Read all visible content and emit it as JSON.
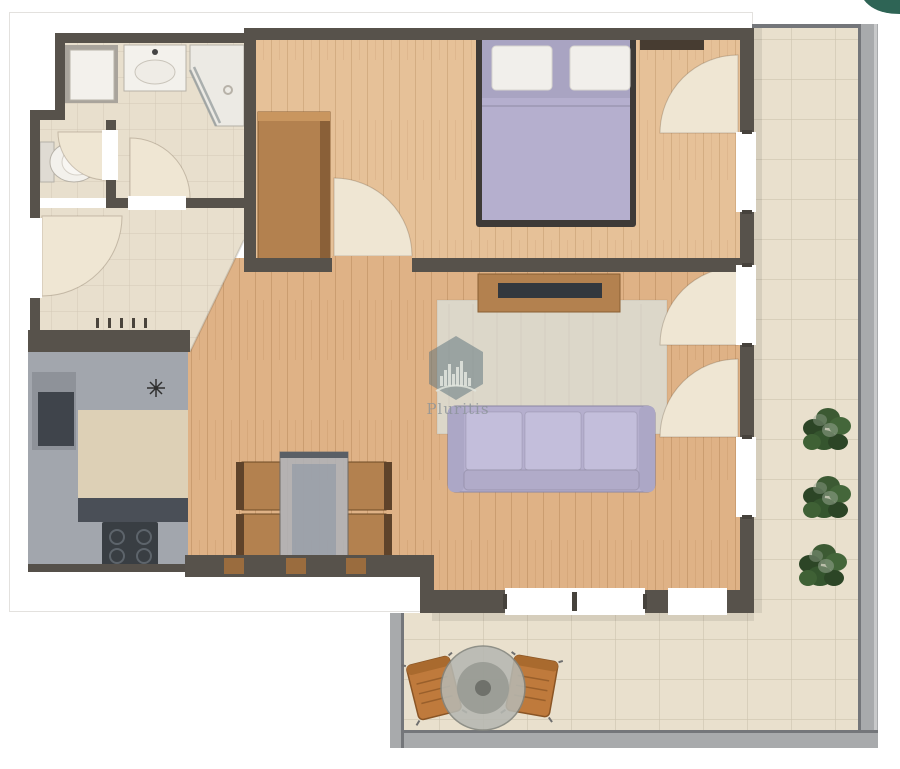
{
  "watermark": {
    "brand_text": "Pluritis",
    "logo_icon": "hexagon-skyline-logo"
  },
  "corner_badge": {
    "icon": "teal-corner-logo-fragment"
  },
  "icons": {
    "kitchen_faucet": "asterisk-star",
    "shower": "corner-glass-diagonal",
    "door_swings": "quarter-circle-arc"
  },
  "colors": {
    "wall": "#57524b",
    "wall_dark": "#3f3b35",
    "frame_line": "#e3e1de",
    "tile": "#e8dfcd",
    "terrace_tile": "#e9e0cd",
    "wood_bed": "#e6c198",
    "wood_living": "#dfb286",
    "door_leaf": "#efe6d3",
    "rug": "#dcd7c9",
    "lavender": "#b5afce",
    "lavender_light": "#c3bedb",
    "lavender_dark": "#8d88a8",
    "bed_frame": "#3e3a37",
    "white_fixture": "#f3f1ec",
    "counter": "#a2a6ad",
    "counter_beige": "#ddd0b6",
    "counter_dark": "#4a4f57",
    "cooktop": "#393e43",
    "wood_furn": "#b3814f",
    "wood_furn_dark": "#6d4a28",
    "glass": "#aab0b8",
    "railing": "#a8aaac",
    "railing_dark": "#74767a",
    "plant": "#3c5a33",
    "plant_dark": "#2c4526",
    "plant_light": "#93a28e",
    "chair_orange": "#bf7a3c",
    "tv": "#33383e",
    "watermark_fill": "#64787f",
    "watermark_text": "#8b9398",
    "badge": "#2e6455"
  }
}
